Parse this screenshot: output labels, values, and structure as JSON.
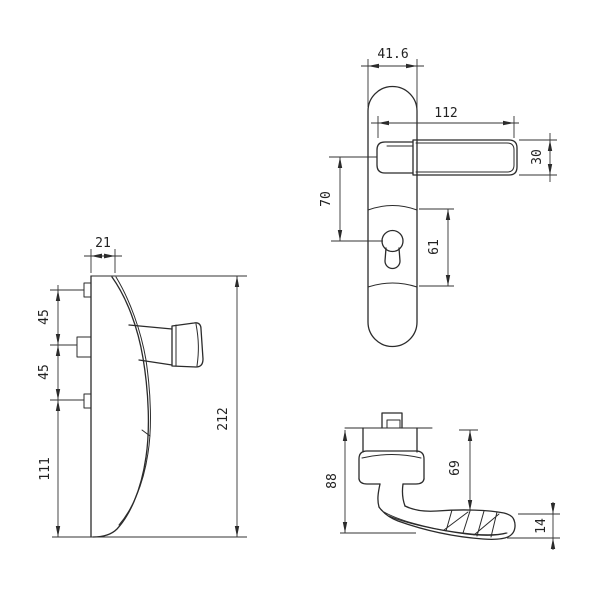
{
  "meta": {
    "title": "door-handle-technical-drawing",
    "background": "#ffffff",
    "line_color": "#2b2b2b"
  },
  "views": {
    "plate_side": {
      "label": "plate-side-view",
      "dims": {
        "top_width": "21",
        "pin_pitch_1": "45",
        "pin_pitch_2": "45",
        "lower_span": "111",
        "overall_height": "212"
      }
    },
    "plate_front": {
      "label": "plate-front-view",
      "dims": {
        "plate_width": "41.6",
        "handle_length": "112",
        "handle_height": "30",
        "handle_to_cylinder": "70",
        "boss_height": "61"
      }
    },
    "handle_side": {
      "label": "handle-side-view",
      "dims": {
        "overall_depth": "88",
        "drop_to_grip": "69",
        "grip_thickness": "14"
      }
    }
  }
}
